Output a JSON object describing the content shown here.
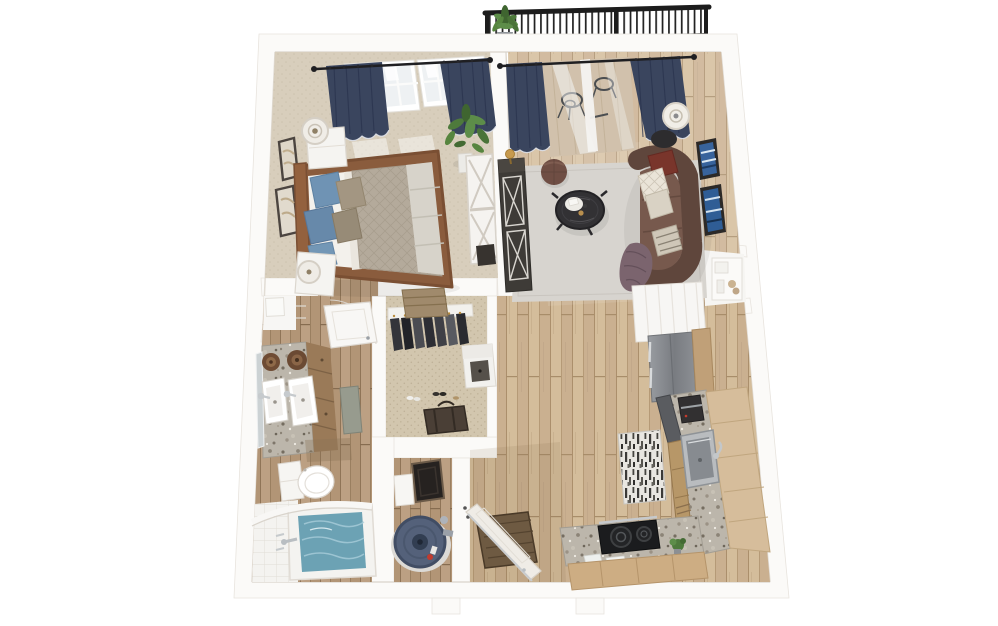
{
  "scene": {
    "kind": "3d-floor-plan-top-down-render",
    "unit_type": "one-bedroom one-bath apartment",
    "background": "#ffffff"
  },
  "palette": {
    "wall": "#fbfaf8",
    "wall_shadow": "#ddd7cf",
    "wood_main": "#d3bc9a",
    "wood_dark": "#b89d7c",
    "carpet_bedroom": "#d8cebc",
    "carpet_closet": "#d2c6ae",
    "rug_living": "#d7d4cf",
    "curtain_navy": "#3a455e",
    "sofa_brown": "#77594d",
    "sofa_back": "#5f463c",
    "bed_duvet": "#b4aa9b",
    "pillow_blue": "#6f93b4",
    "granite": "#bcb6ab",
    "cabinet_wood": "#c0a078",
    "tub_water": "#6ca2b4",
    "water_heater": "#54617a",
    "railing_black": "#1d1d1d",
    "plant_green": "#4e7a3c",
    "art_blue": "#38639c"
  },
  "rooms": {
    "balcony": {
      "label": "Balcony",
      "items": [
        "black metal railing",
        "potted plant",
        "bistro chairs seen through glass door"
      ]
    },
    "bedroom": {
      "label": "Bedroom",
      "items": [
        "queen bed with wood frame",
        "blue and taupe pillows",
        "quilted duvet",
        "two white nightstands",
        "two table lamps",
        "two framed artworks",
        "fiddle-leaf plant",
        "white sliding barn door",
        "double windows with navy curtains",
        "beige carpet"
      ]
    },
    "living_room": {
      "label": "Living Room",
      "items": [
        "curved brown leather sofa",
        "maroon and cream pillows",
        "purple throw",
        "round black coffee table with tray",
        "brown ottoman pouf",
        "dark media console with X doors",
        "brass accent lamp",
        "table lamp on black side table",
        "two blue framed artworks",
        "gray area rug",
        "sliding glass balcony door with navy curtains"
      ]
    },
    "closet": {
      "label": "Walk-in Closet",
      "items": [
        "hanging clothes",
        "woven storage basket",
        "white dresser",
        "duffel bag",
        "shoes",
        "patterned carpet"
      ]
    },
    "bathroom": {
      "label": "Bathroom",
      "items": [
        "double granite vanity",
        "two sinks with chrome faucets",
        "mirror",
        "two wooden bowls",
        "toilet",
        "soaking tub with water",
        "white tile surround",
        "gray bath mat",
        "linen nook with box",
        "open white door"
      ]
    },
    "utility": {
      "label": "Utility Closet",
      "items": [
        "water heater with drain pan",
        "white storage box",
        "dark framed panel"
      ]
    },
    "kitchen": {
      "label": "Kitchen",
      "items": [
        "stainless refrigerator",
        "white upper cabinets",
        "granite L-counter",
        "stainless sink with faucet",
        "coffee maker",
        "black two-burner cooktop",
        "wood base cabinets",
        "black-and-white runner rug",
        "small herb plant"
      ]
    },
    "entry": {
      "label": "Entry",
      "items": [
        "open front door",
        "dark wood doormat",
        "door hinges"
      ]
    }
  }
}
